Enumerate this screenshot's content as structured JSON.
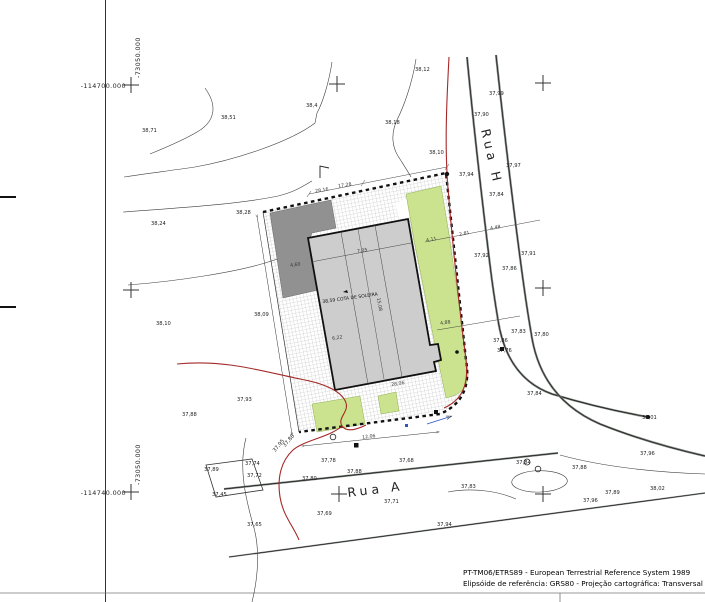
{
  "coords": {
    "top_x": "-114700.000",
    "top_y": "-73050.000",
    "bottom_x": "-114740.000",
    "bottom_y": "-73050.000"
  },
  "streets": {
    "rua_h": "Rua H",
    "rua_a": "Rua A"
  },
  "building": {
    "threshold_label": "38,59 COTA DE SOLEIRA"
  },
  "footer": {
    "line1": "PT-TM06/ETRS89 - European Terrestrial Reference System 1989",
    "line2": "Elipsóide de referência: GRS80 - Projeção cartográfica: Transversal de Mercator"
  },
  "spots": [
    {
      "v": "38,12"
    },
    {
      "v": "38,4"
    },
    {
      "v": "38,51"
    },
    {
      "v": "38,71"
    },
    {
      "v": "38,18"
    },
    {
      "v": "38,10"
    },
    {
      "v": "37,99"
    },
    {
      "v": "37,90"
    },
    {
      "v": "37,97"
    },
    {
      "v": "37,94"
    },
    {
      "v": "37,84"
    },
    {
      "v": "38,28"
    },
    {
      "v": "38,24"
    },
    {
      "v": "38,09"
    },
    {
      "v": "38,10"
    },
    {
      "v": "37,86"
    },
    {
      "v": "37,92"
    },
    {
      "v": "37,91"
    },
    {
      "v": "37,83"
    },
    {
      "v": "37,80"
    },
    {
      "v": "37,86"
    },
    {
      "v": "37,76"
    },
    {
      "v": "37,93"
    },
    {
      "v": "37,88"
    },
    {
      "v": "37,84"
    },
    {
      "v": "38,01"
    },
    {
      "v": "37,96"
    },
    {
      "v": "37,84"
    },
    {
      "v": "37,88"
    },
    {
      "v": "37,89"
    },
    {
      "v": "38,02"
    },
    {
      "v": "37,94"
    },
    {
      "v": "37,78"
    },
    {
      "v": "37,88"
    },
    {
      "v": "37,80"
    },
    {
      "v": "37,68"
    },
    {
      "v": "37,71"
    },
    {
      "v": "37,69"
    },
    {
      "v": "37,83"
    },
    {
      "v": "37,89"
    },
    {
      "v": "37,74"
    },
    {
      "v": "37,72"
    },
    {
      "v": "37,45"
    },
    {
      "v": "37,65"
    },
    {
      "v": "37,95"
    },
    {
      "v": "37,88"
    },
    {
      "v": "37,96"
    }
  ],
  "dims": [
    {
      "v": "28,16"
    },
    {
      "v": "17,28"
    },
    {
      "v": "4,60"
    },
    {
      "v": "7,05"
    },
    {
      "v": "15,08"
    },
    {
      "v": "6,22"
    },
    {
      "v": "28,06"
    },
    {
      "v": "4,11"
    },
    {
      "v": "2,81"
    },
    {
      "v": "4,48"
    },
    {
      "v": "4,88"
    },
    {
      "v": "12,06"
    }
  ],
  "colors": {
    "green_area": "#cbe38e",
    "dark_block": "#919191",
    "building_fill": "#cdcdcd",
    "red_line": "#a52828",
    "blue_mark": "#2d55c8",
    "road_casing": "#7d837d"
  }
}
